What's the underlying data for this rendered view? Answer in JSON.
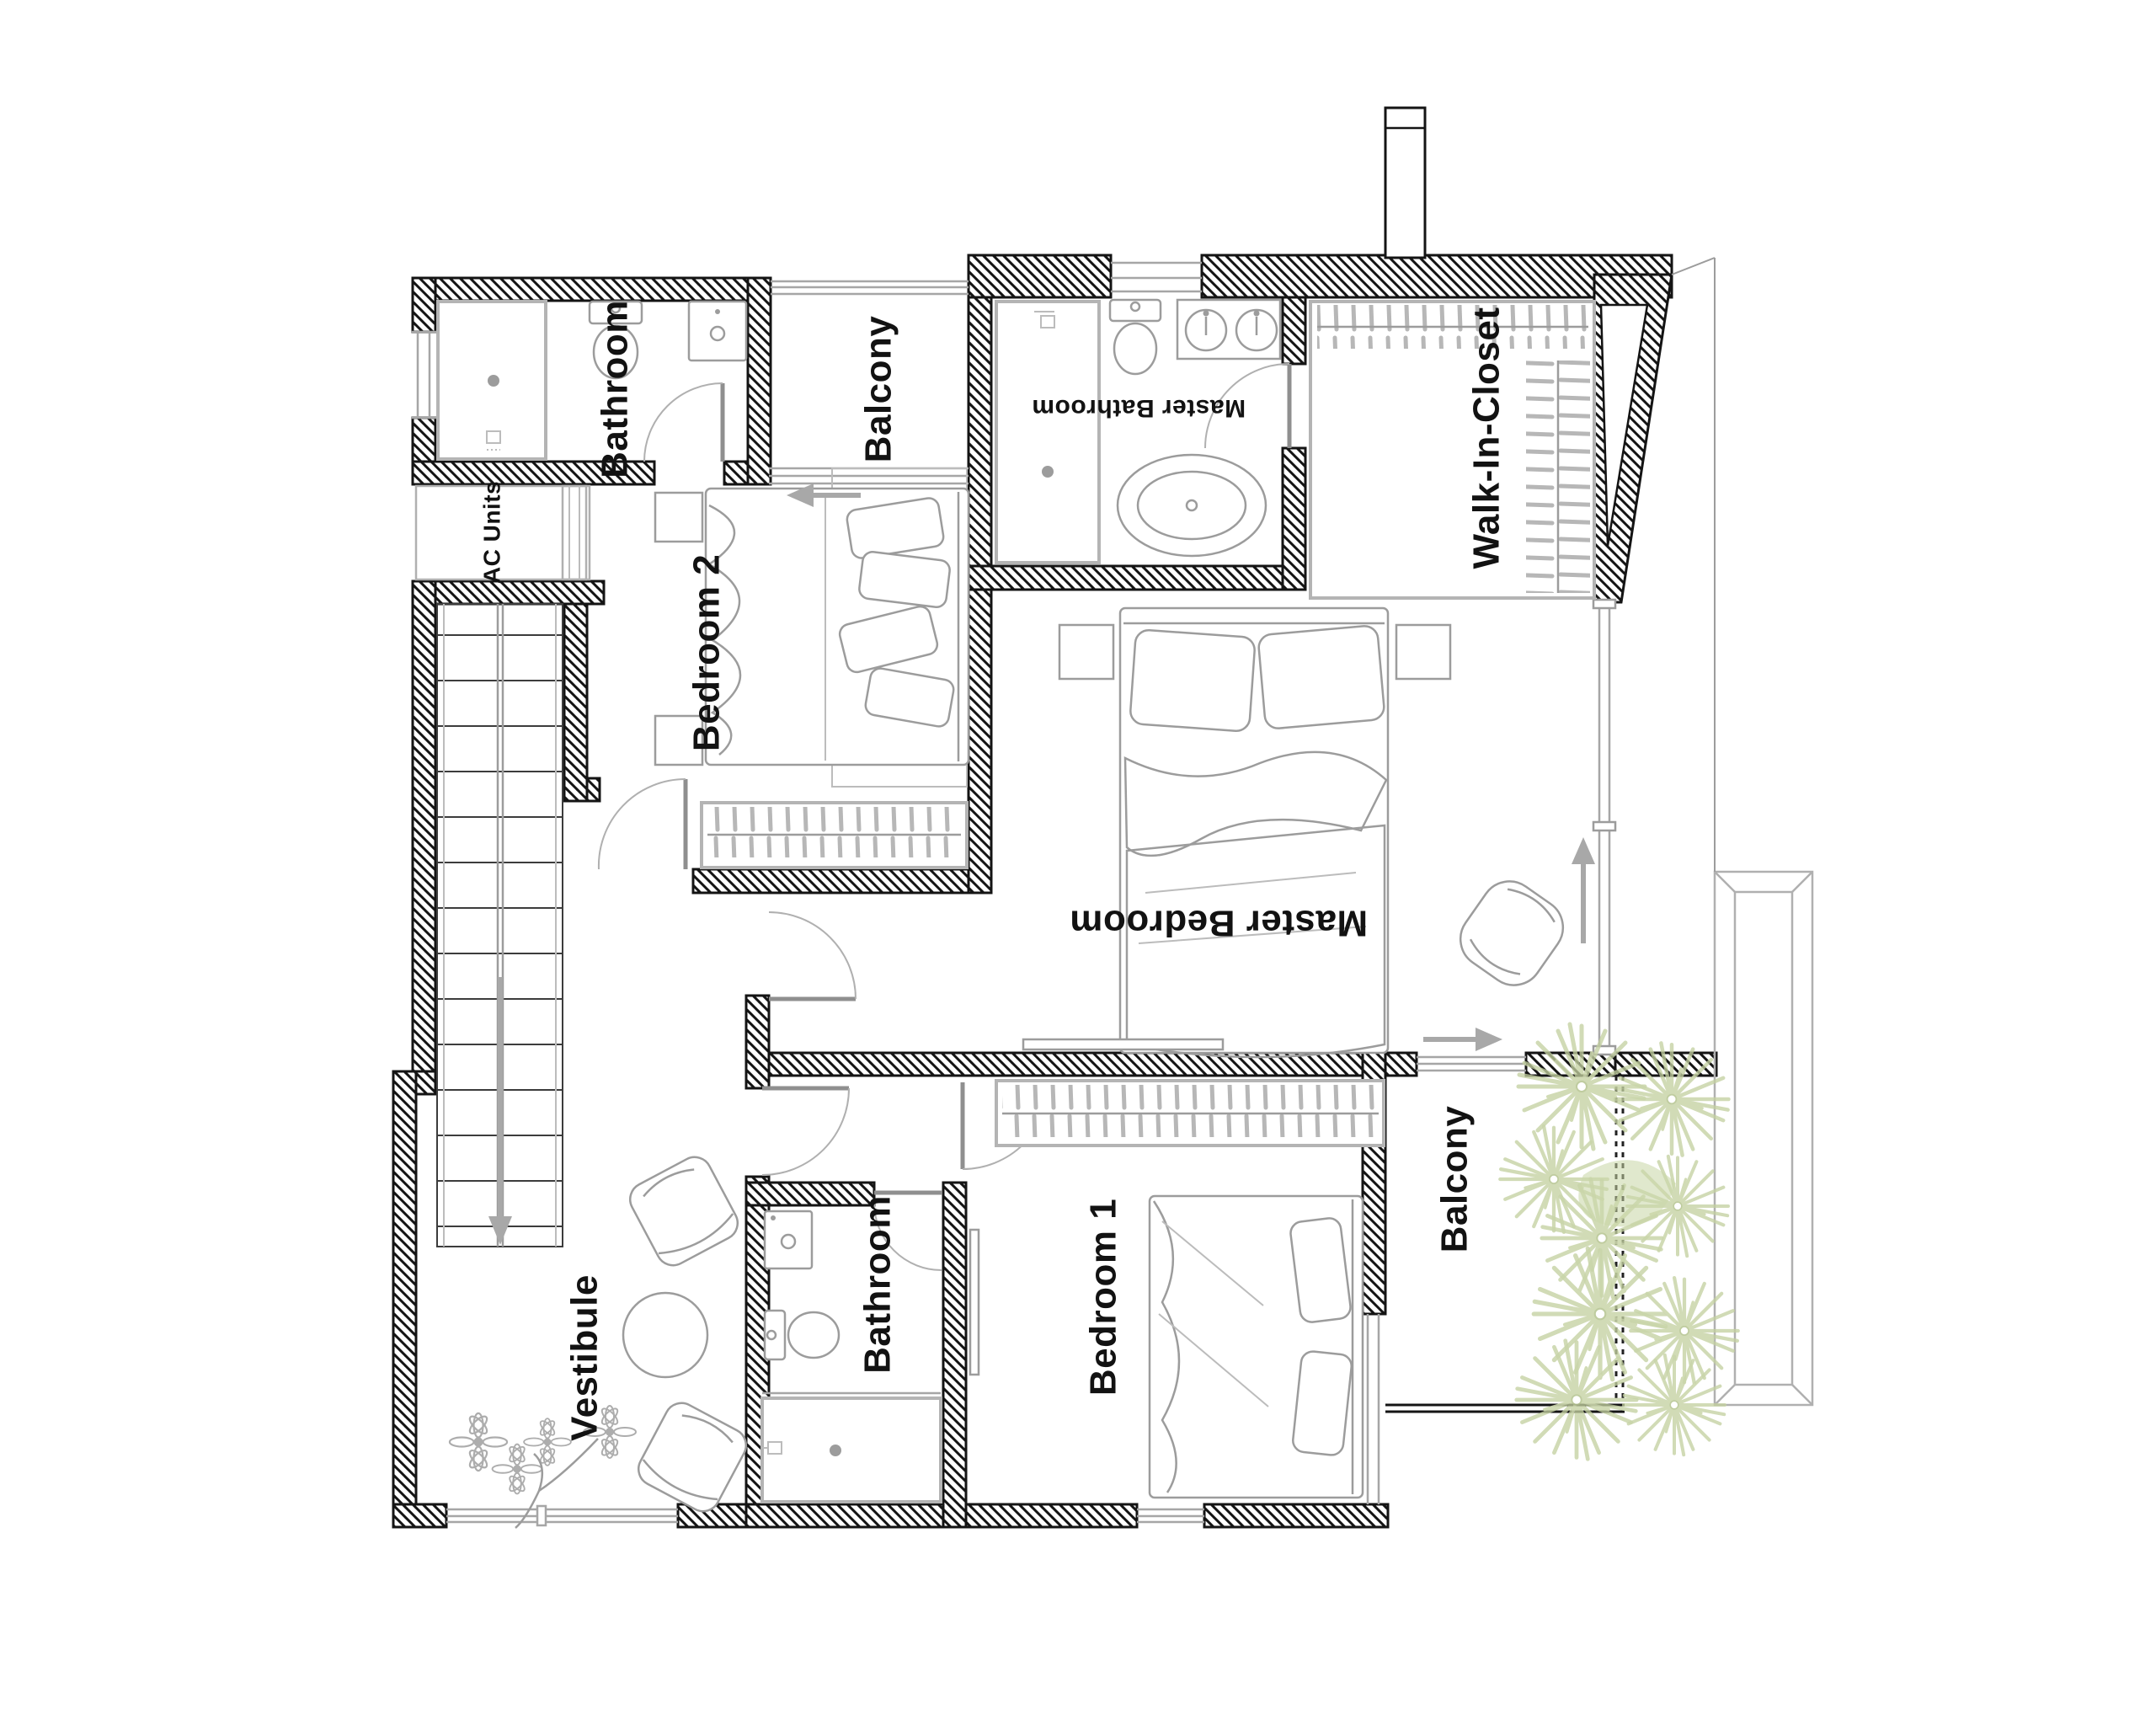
{
  "plan": {
    "type": "architectural-floor-plan",
    "floor": "bedroom level",
    "background": "#ffffff"
  },
  "palette": {
    "wall_hatch": "#141414",
    "furniture_outline": "#9c9c9c",
    "light_outline": "#bcbcbc",
    "glass": "#a6a6a6",
    "plant_green": "#c5d1a1",
    "label_color": "#121212"
  },
  "rooms": [
    {
      "id": "bathroom-top-left",
      "label": "Bathroom",
      "rotation_deg": -90
    },
    {
      "id": "balcony-top",
      "label": "Balcony",
      "rotation_deg": -90
    },
    {
      "id": "master-bathroom",
      "label": "Master Bathroom",
      "rotation_deg": 180
    },
    {
      "id": "walk-in-closet",
      "label": "Walk-In-Closet",
      "rotation_deg": -90
    },
    {
      "id": "ac-units",
      "label": "AC Units",
      "rotation_deg": -90
    },
    {
      "id": "bedroom-2",
      "label": "Bedroom 2",
      "rotation_deg": -90
    },
    {
      "id": "master-bedroom",
      "label": "Master Bedroom",
      "rotation_deg": 180
    },
    {
      "id": "vestibule",
      "label": "Vestibule",
      "rotation_deg": -90
    },
    {
      "id": "bathroom-bottom",
      "label": "Bathroom",
      "rotation_deg": -90
    },
    {
      "id": "bedroom-1",
      "label": "Bedroom 1",
      "rotation_deg": -90
    },
    {
      "id": "balcony-bottom",
      "label": "Balcony",
      "rotation_deg": -90
    }
  ],
  "symbols": [
    "shower",
    "toilet",
    "sink",
    "double-sink-vanity",
    "freestanding-bathtub",
    "double-bed",
    "pillows",
    "closet-hangers",
    "armchair",
    "round-side-table",
    "flower-plant",
    "palm-plant",
    "staircase",
    "stairs-down-arrow",
    "door-swing",
    "sliding-door-arrow",
    "tv-panel",
    "window",
    "chimney"
  ]
}
